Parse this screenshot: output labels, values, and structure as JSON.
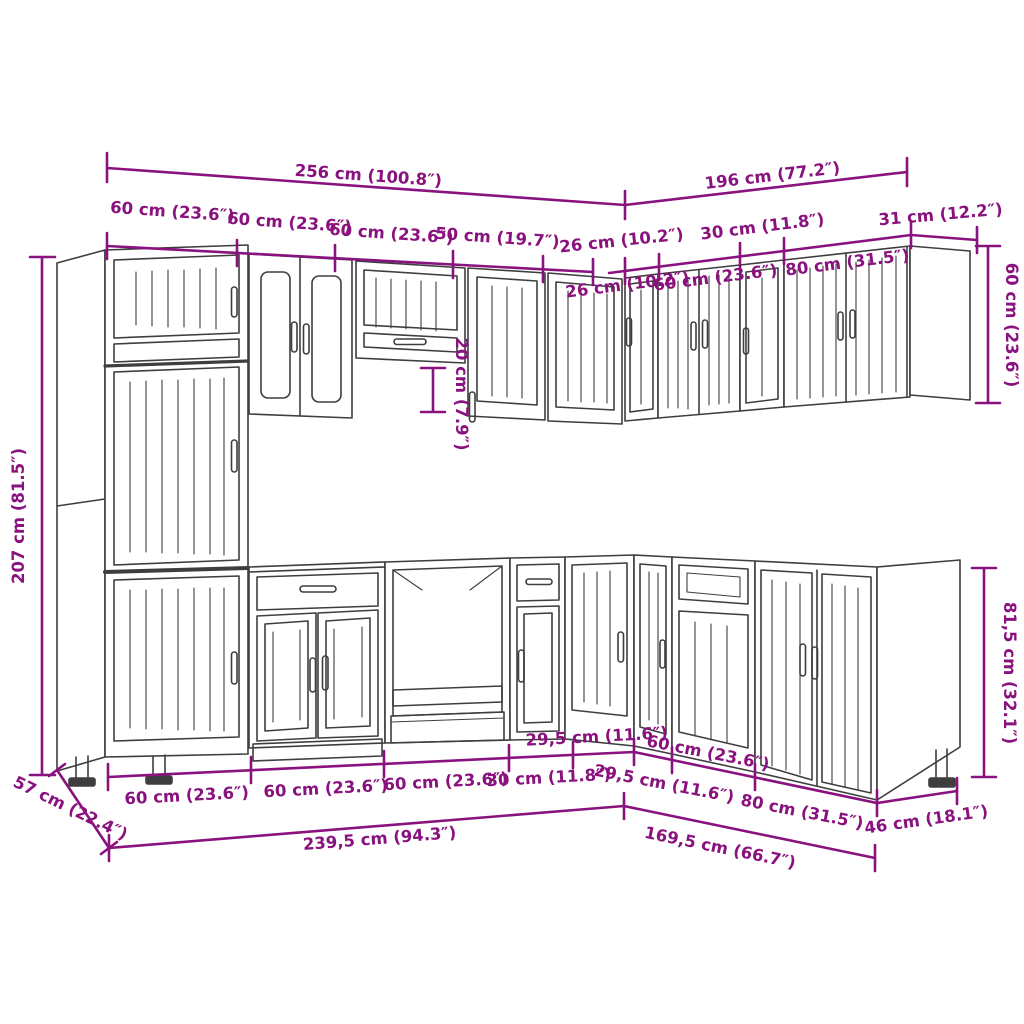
{
  "title": "Kitchen cabinet set dimension diagram",
  "colors": {
    "dimension": "#8A127F",
    "line": "#3E3E3E",
    "background": "#ffffff"
  },
  "dims": {
    "top_totals": {
      "left": "256 cm (100.8″)",
      "right": "196 cm (77.2″)"
    },
    "top_segments": {
      "s60a": "60 cm (23.6″)",
      "s60b": "60 cm (23.6″)",
      "s60c": "60 cm (23.6″)",
      "s50": "50 cm (19.7″)",
      "s26l": "26 cm (10.2″)",
      "s30": "30 cm (11.8″)",
      "s31": "31 cm (12.2″)",
      "s26r": "26 cm (10.2″)",
      "s60r": "60 cm (23.6″)",
      "s80": "80 cm (31.5″)"
    },
    "verticals": {
      "tall_height": "207 cm (81.5″)",
      "hood_gap": "20 cm (7.9″)",
      "wall_height": "60 cm (23.6″)",
      "base_height": "81,5 cm (32.1″)"
    },
    "depths": {
      "left": "57 cm (22.4″)",
      "right": "46 cm (18.1″)"
    },
    "bottom_segments": {
      "b60a": "60 cm (23.6″)",
      "b60b": "60 cm (23.6″)",
      "b60c": "60 cm (23.6″)",
      "b30": "30 cm (11.8″)",
      "b295l": "29,5 cm (11.6″)",
      "b295r": "29,5 cm (11.6″)",
      "b60r": "60 cm (23.6″)",
      "b80": "80 cm (31.5″)"
    },
    "bottom_totals": {
      "left": "239,5 cm (94.3″)",
      "right": "169,5 cm (66.7″)"
    }
  }
}
